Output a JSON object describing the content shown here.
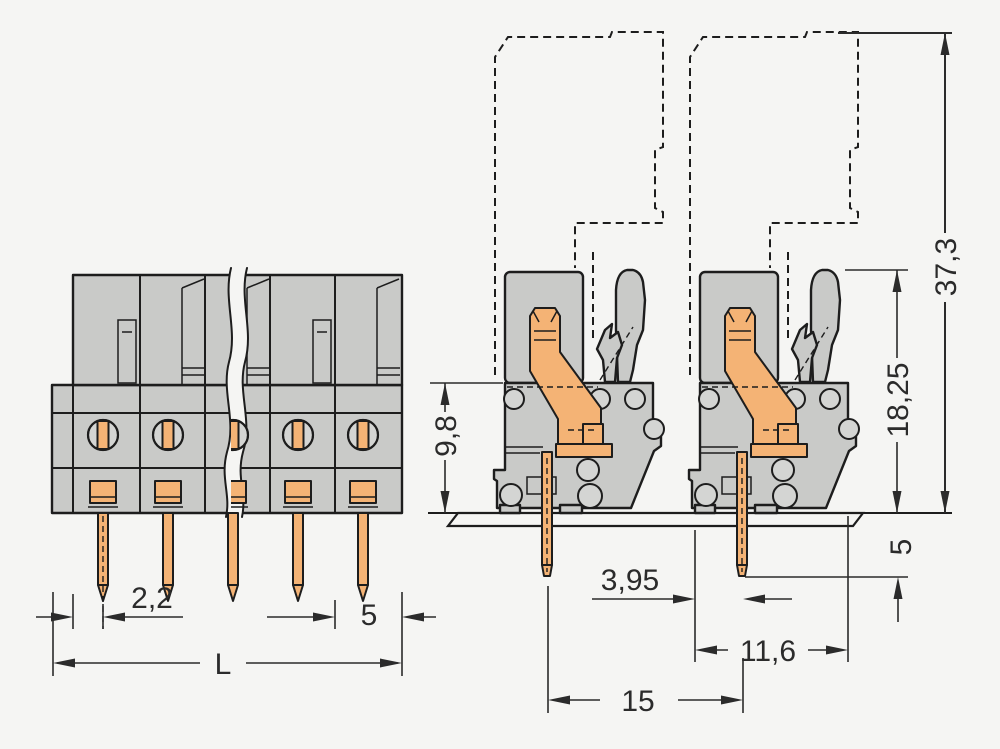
{
  "drawing": {
    "kind": "technical-dimension-drawing",
    "subject": "PCB female header terminal block, front view and side view mounted on printed circuit board",
    "views": {
      "front": {
        "poles_visible": 5,
        "has_break_line": true
      },
      "side": {
        "connectors_shown": 2,
        "mating_plug_phantom": true,
        "mounted_on_pcb": true
      }
    }
  },
  "dims": {
    "pin_offset": "2,2",
    "pitch": "5",
    "overall_length": "L",
    "body_height": "9,8",
    "latch_height": "18,25",
    "total_height": "37,3",
    "pin_below_board": "5",
    "pin_to_face": "3,95",
    "depth": "11,6",
    "pin_spacing": "15"
  },
  "colors": {
    "background": "#f5f5f3",
    "line": "#1d1d1d",
    "housing": "#c9cac8",
    "housing_light": "#d4d5d3",
    "contact": "#f4b375",
    "pcb": "#8fbe7e",
    "pcb_hatch": "#3c6e38",
    "dim": "#2b2b2b"
  }
}
